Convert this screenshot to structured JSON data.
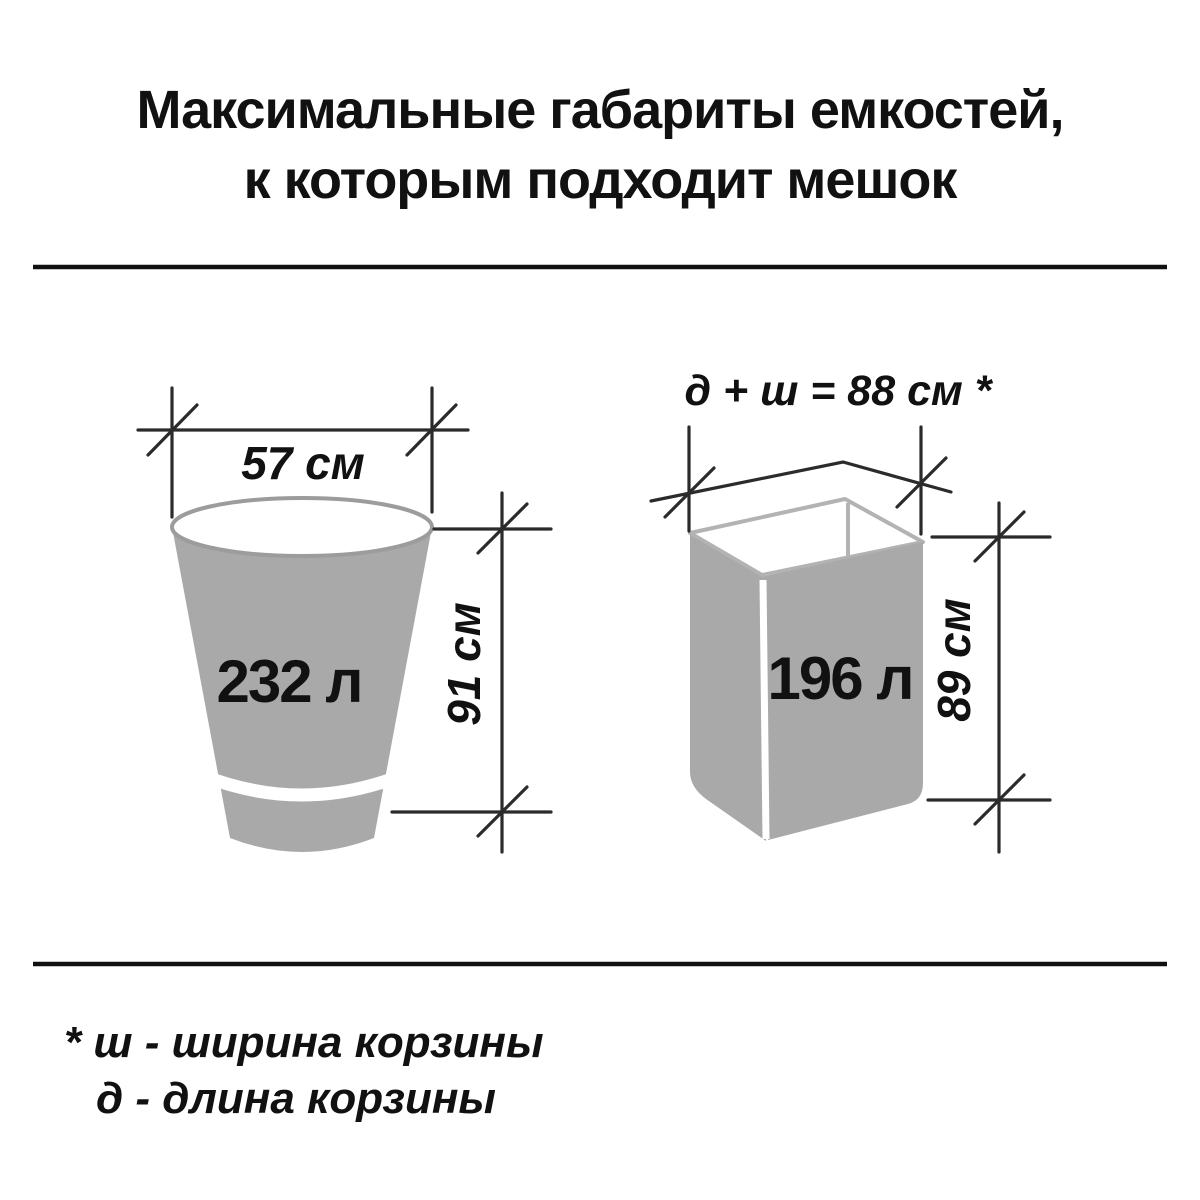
{
  "title": {
    "line1": "Максимальные габариты емкостей,",
    "line2": "к которым подходит мешок"
  },
  "figures": {
    "bucket": {
      "width_label": "57 см",
      "height_label": "91 см",
      "volume_label": "232 л"
    },
    "basket": {
      "formula_label": "д + ш = 88 см *",
      "height_label": "89 см",
      "volume_label": "196 л"
    }
  },
  "footnotes": {
    "line1": "* ш - ширина корзины",
    "line2": "д - длина корзины"
  },
  "colors": {
    "background": "#ffffff",
    "container_fill": "#a9a9a9",
    "bucket_rim_outline": "#9c9c9c",
    "basket_rim_outline": "#b3b3b3",
    "dimension_line": "#2b2b2b",
    "divider": "#111111",
    "text": "#111111"
  }
}
